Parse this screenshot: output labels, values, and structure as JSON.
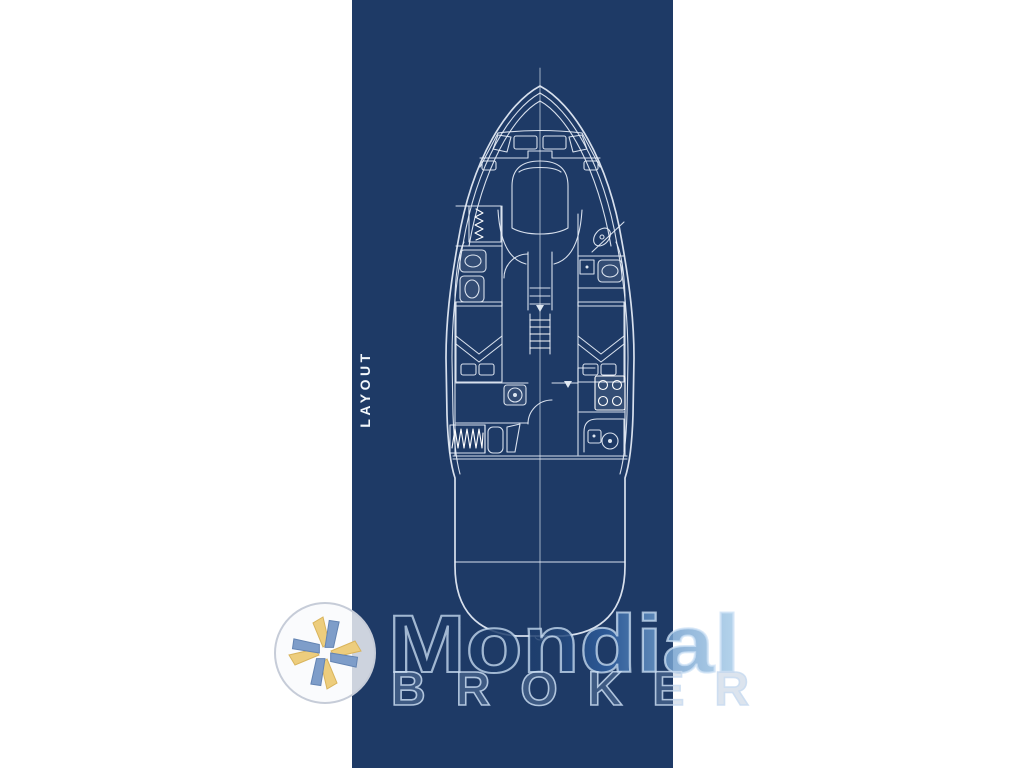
{
  "theme": {
    "page-bg": "#ffffff",
    "panel-bg": "#1e3a66",
    "line": "#e8eff8",
    "line-bright": "#ffffff",
    "label-color": "#f3f7fb",
    "wm-dark": "#1b3762",
    "wm-light": "#abcfea",
    "wm-outline": "#cfe0f2",
    "wm-broker-fill": "#8aa6c6",
    "logo-yellow": "#edcd7d",
    "logo-blue": "#7e9dc9",
    "logo-ring": "#c6ccd8"
  },
  "panel": {
    "label": "LAYOUT"
  },
  "drawing": {
    "type": "yacht-deck-plan-blueprint"
  },
  "watermark": {
    "brand": "Mondial",
    "brand_sub": "BROKER"
  }
}
